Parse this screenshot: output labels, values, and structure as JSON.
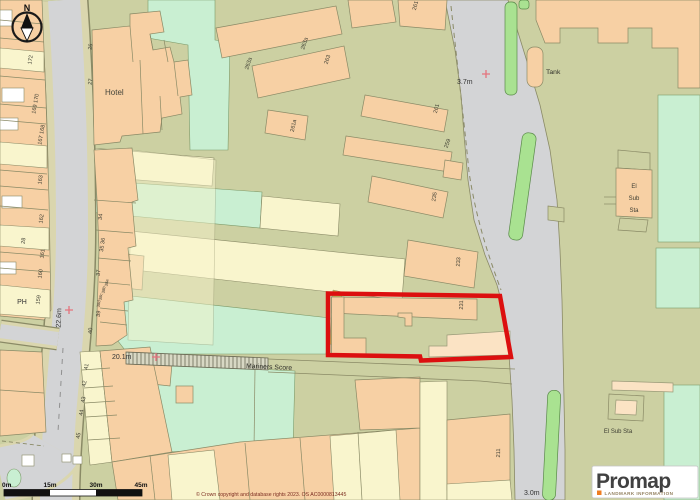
{
  "map": {
    "north_label": "N",
    "labels": {
      "hotel": "Hotel",
      "ph": "PH",
      "tank": "Tank",
      "el_sub_sta_lines": [
        "El",
        "Sub",
        "Sta"
      ],
      "el_sub_sta": "El Sub Sta",
      "street": "Mariners Score"
    },
    "spot_heights": {
      "h1": "3.7m",
      "h2": "22.6m",
      "h3": "20.1m",
      "h4": "3.0m"
    },
    "nums": [
      "174",
      "172",
      "169 170",
      "167 168",
      "163",
      "162",
      "161",
      "160",
      "159",
      "28",
      "26",
      "27",
      "34",
      "35 36",
      "37",
      "38a",
      "38b",
      "38c",
      "38d",
      "39",
      "40",
      "41",
      "42",
      "43",
      "44",
      "45",
      "263a",
      "263a",
      "263",
      "261",
      "261",
      "259",
      "261a",
      "235",
      "233",
      "231",
      "211"
    ]
  },
  "scalebar": {
    "t0": "0m",
    "t1": "15m",
    "t2": "30m",
    "t3": "45m"
  },
  "footer": {
    "copyright": "© Crown copyright and database rights 2023. OS AC0000813445"
  },
  "logo": {
    "brand": "Promap",
    "tagline": "LANDMARK INFORMATION"
  },
  "colors": {
    "plot_outline": "#dc0f0f",
    "building": "#f7d0a4",
    "building_pale": "#fbe3c4",
    "garden_cream": "#f9f5cd",
    "grass_mint": "#c9efd2",
    "verge_green": "#a9e291",
    "road": "#d3d4d6",
    "land": "#ccd0a2",
    "cross": "#e4737e",
    "logo_orange": "#ef7d20"
  }
}
